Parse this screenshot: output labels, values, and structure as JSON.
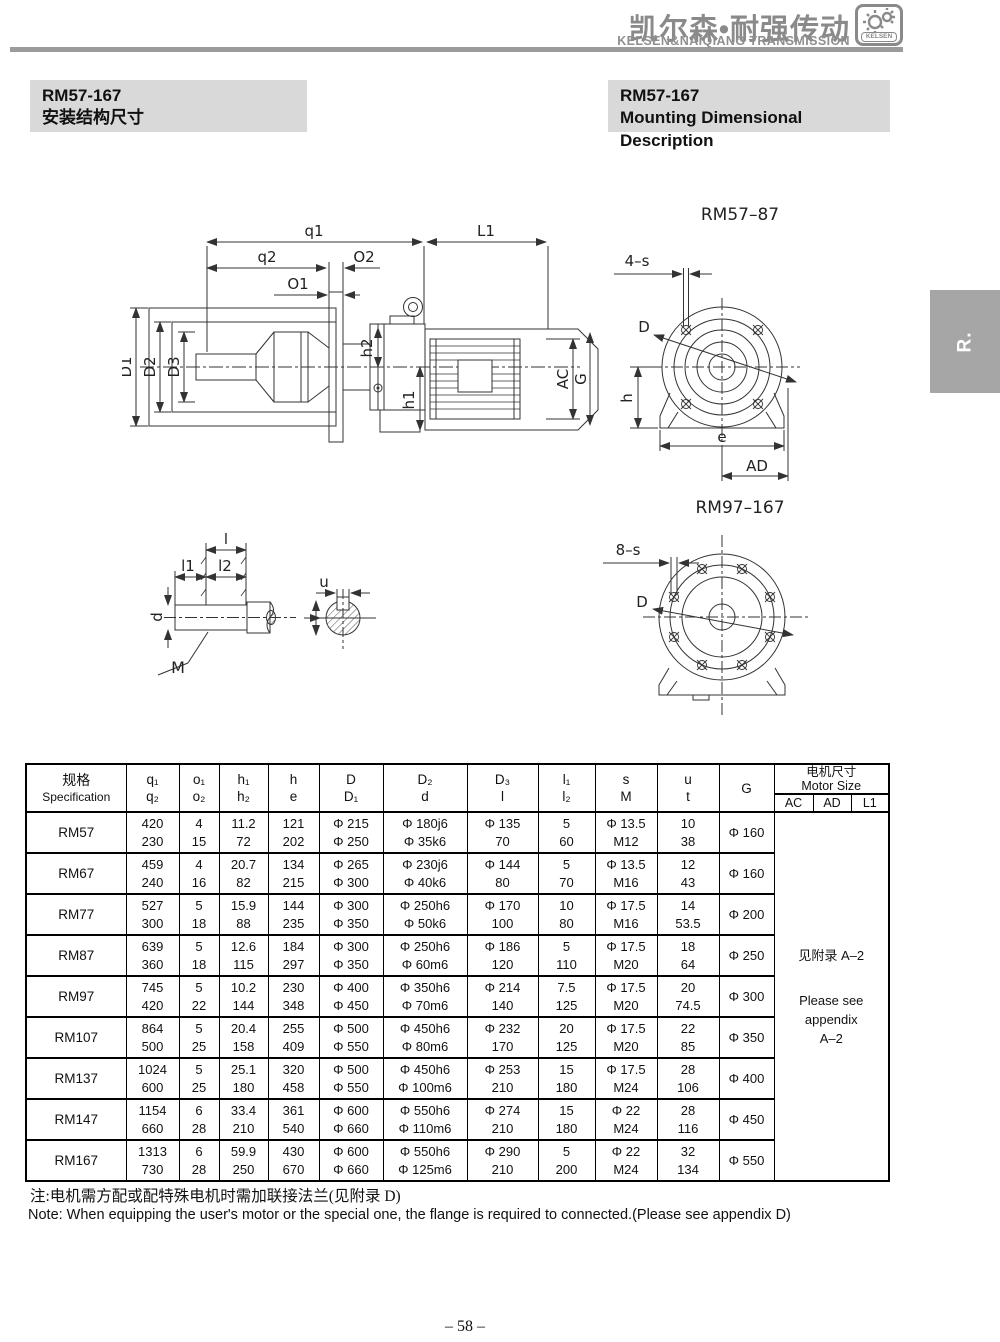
{
  "header": {
    "brand_cn": "凯尔森•耐强传动",
    "brand_en": "KELSEN&NAIQIANG TRANSMISSION",
    "logo_text": "KELSEN"
  },
  "titles": {
    "left": {
      "line1": "RM57-167",
      "line2": "安装结构尺寸"
    },
    "right": {
      "line1": "RM57-167",
      "line2": "Mounting Dimensional Description"
    }
  },
  "side_tab": "R.",
  "drawings": {
    "side": {
      "q1": "q1",
      "q2": "q2",
      "o1": "O1",
      "o2": "O2",
      "l1": "L1",
      "d1": "D1",
      "d2": "D2",
      "d3": "D3",
      "h1": "h1",
      "h2": "h2",
      "ac": "AC",
      "g": "G"
    },
    "flange_small": {
      "title": "RM57–87",
      "dim_s": "4–s",
      "d": "D",
      "h": "h",
      "e": "e",
      "ad": "AD"
    },
    "flange_large": {
      "title": "RM97–167",
      "dim_s": "8–s",
      "d": "D"
    },
    "shaft": {
      "l": "l",
      "l1": "l1",
      "l2": "l2",
      "d": "d",
      "m": "M",
      "u": "u"
    }
  },
  "table": {
    "header": {
      "spec_cn": "规格",
      "spec_en": "Specification",
      "pairs": [
        [
          "q₁",
          "q₂"
        ],
        [
          "o₁",
          "o₂"
        ],
        [
          "h₁",
          "h₂"
        ],
        [
          "h",
          "e"
        ],
        [
          "D",
          "D₁"
        ],
        [
          "D₂",
          "d"
        ],
        [
          "D₃",
          "l"
        ],
        [
          "l₁",
          "l₂"
        ],
        [
          "s",
          "M"
        ],
        [
          "u",
          "t"
        ]
      ],
      "g": "G",
      "motor_cn": "电机尺寸",
      "motor_en": "Motor Size",
      "motor_sub": [
        "AC",
        "AD",
        "L1"
      ]
    },
    "rows": [
      {
        "spec": "RM57",
        "pairs": [
          [
            "420",
            "230"
          ],
          [
            "4",
            "15"
          ],
          [
            "11.2",
            "72"
          ],
          [
            "121",
            "202"
          ],
          [
            "Φ 215",
            "Φ 250"
          ],
          [
            "Φ 180j6",
            "Φ 35k6"
          ],
          [
            "Φ 135",
            "70"
          ],
          [
            "5",
            "60"
          ],
          [
            "Φ 13.5",
            "M12"
          ],
          [
            "10",
            "38"
          ]
        ],
        "g": "Φ 160"
      },
      {
        "spec": "RM67",
        "pairs": [
          [
            "459",
            "240"
          ],
          [
            "4",
            "16"
          ],
          [
            "20.7",
            "82"
          ],
          [
            "134",
            "215"
          ],
          [
            "Φ 265",
            "Φ 300"
          ],
          [
            "Φ 230j6",
            "Φ 40k6"
          ],
          [
            "Φ 144",
            "80"
          ],
          [
            "5",
            "70"
          ],
          [
            "Φ 13.5",
            "M16"
          ],
          [
            "12",
            "43"
          ]
        ],
        "g": "Φ 160"
      },
      {
        "spec": "RM77",
        "pairs": [
          [
            "527",
            "300"
          ],
          [
            "5",
            "18"
          ],
          [
            "15.9",
            "88"
          ],
          [
            "144",
            "235"
          ],
          [
            "Φ 300",
            "Φ 350"
          ],
          [
            "Φ 250h6",
            "Φ 50k6"
          ],
          [
            "Φ 170",
            "100"
          ],
          [
            "10",
            "80"
          ],
          [
            "Φ 17.5",
            "M16"
          ],
          [
            "14",
            "53.5"
          ]
        ],
        "g": "Φ 200"
      },
      {
        "spec": "RM87",
        "pairs": [
          [
            "639",
            "360"
          ],
          [
            "5",
            "18"
          ],
          [
            "12.6",
            "115"
          ],
          [
            "184",
            "297"
          ],
          [
            "Φ 300",
            "Φ 350"
          ],
          [
            "Φ 250h6",
            "Φ 60m6"
          ],
          [
            "Φ 186",
            "120"
          ],
          [
            "5",
            "110"
          ],
          [
            "Φ 17.5",
            "M20"
          ],
          [
            "18",
            "64"
          ]
        ],
        "g": "Φ 250"
      },
      {
        "spec": "RM97",
        "pairs": [
          [
            "745",
            "420"
          ],
          [
            "5",
            "22"
          ],
          [
            "10.2",
            "144"
          ],
          [
            "230",
            "348"
          ],
          [
            "Φ 400",
            "Φ 450"
          ],
          [
            "Φ 350h6",
            "Φ 70m6"
          ],
          [
            "Φ 214",
            "140"
          ],
          [
            "7.5",
            "125"
          ],
          [
            "Φ 17.5",
            "M20"
          ],
          [
            "20",
            "74.5"
          ]
        ],
        "g": "Φ 300"
      },
      {
        "spec": "RM107",
        "pairs": [
          [
            "864",
            "500"
          ],
          [
            "5",
            "25"
          ],
          [
            "20.4",
            "158"
          ],
          [
            "255",
            "409"
          ],
          [
            "Φ 500",
            "Φ 550"
          ],
          [
            "Φ 450h6",
            "Φ 80m6"
          ],
          [
            "Φ 232",
            "170"
          ],
          [
            "20",
            "125"
          ],
          [
            "Φ 17.5",
            "M20"
          ],
          [
            "22",
            "85"
          ]
        ],
        "g": "Φ 350"
      },
      {
        "spec": "RM137",
        "pairs": [
          [
            "1024",
            "600"
          ],
          [
            "5",
            "25"
          ],
          [
            "25.1",
            "180"
          ],
          [
            "320",
            "458"
          ],
          [
            "Φ 500",
            "Φ 550"
          ],
          [
            "Φ 450h6",
            "Φ 100m6"
          ],
          [
            "Φ 253",
            "210"
          ],
          [
            "15",
            "180"
          ],
          [
            "Φ 17.5",
            "M24"
          ],
          [
            "28",
            "106"
          ]
        ],
        "g": "Φ 400"
      },
      {
        "spec": "RM147",
        "pairs": [
          [
            "1154",
            "660"
          ],
          [
            "6",
            "28"
          ],
          [
            "33.4",
            "210"
          ],
          [
            "361",
            "540"
          ],
          [
            "Φ 600",
            "Φ 660"
          ],
          [
            "Φ 550h6",
            "Φ 110m6"
          ],
          [
            "Φ 274",
            "210"
          ],
          [
            "15",
            "180"
          ],
          [
            "Φ 22",
            "M24"
          ],
          [
            "28",
            "116"
          ]
        ],
        "g": "Φ 450"
      },
      {
        "spec": "RM167",
        "pairs": [
          [
            "1313",
            "730"
          ],
          [
            "6",
            "28"
          ],
          [
            "59.9",
            "250"
          ],
          [
            "430",
            "670"
          ],
          [
            "Φ 600",
            "Φ 660"
          ],
          [
            "Φ 550h6",
            "Φ 125m6"
          ],
          [
            "Φ 290",
            "210"
          ],
          [
            "5",
            "200"
          ],
          [
            "Φ 22",
            "M24"
          ],
          [
            "32",
            "134"
          ]
        ],
        "g": "Φ 550"
      }
    ],
    "motor_note": {
      "cn": "见附录 A–2",
      "en": [
        "Please see",
        "appendix",
        "A–2"
      ]
    }
  },
  "notes": {
    "cn": "注:电机需方配或配特殊电机时需加联接法兰(见附录 D)",
    "en": "Note: When equipping the user's motor or the special one, the flange is required to connected.(Please see appendix D)"
  },
  "page_number": "– 58 –"
}
